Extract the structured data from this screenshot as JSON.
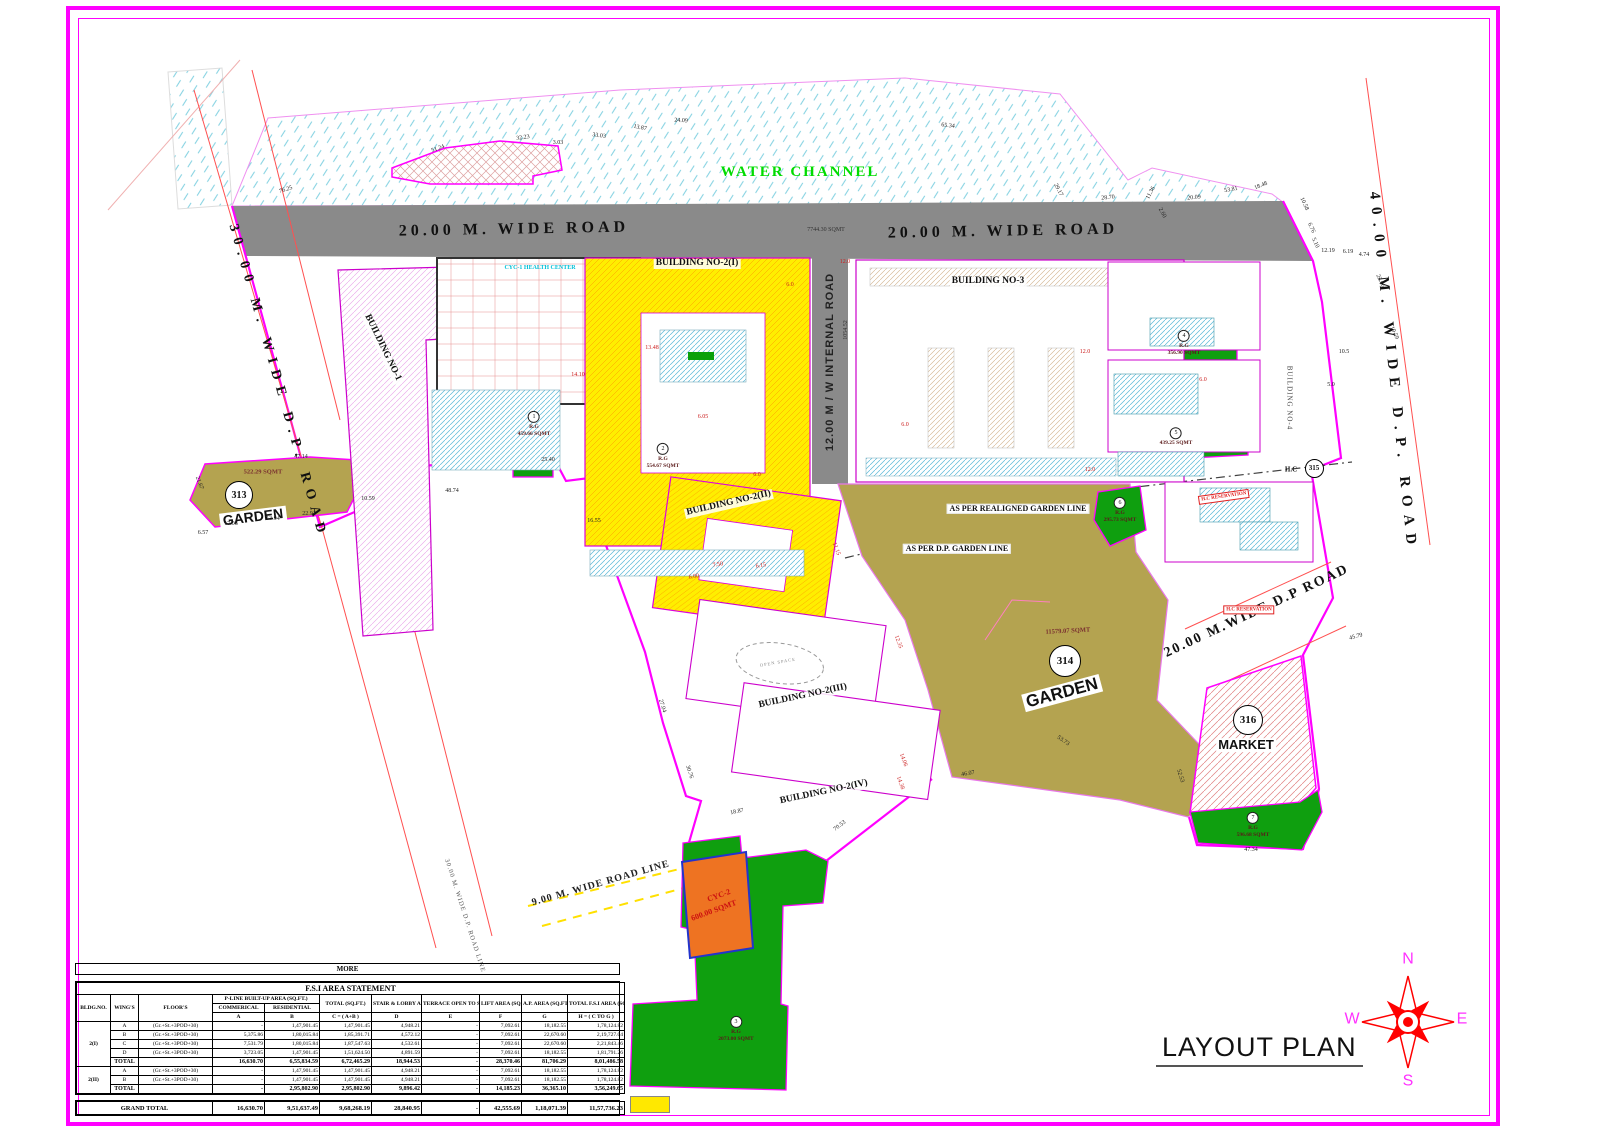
{
  "title": {
    "layout_plan": "LAYOUT PLAN"
  },
  "compass": {
    "letters": [
      {
        "name": "compass-n",
        "t": "N",
        "x": 1408,
        "y": 960
      },
      {
        "name": "compass-e",
        "t": "E",
        "x": 1462,
        "y": 1020
      },
      {
        "name": "compass-s",
        "t": "S",
        "x": 1408,
        "y": 1082
      },
      {
        "name": "compass-w",
        "t": "W",
        "x": 1352,
        "y": 1020
      }
    ]
  },
  "plan": {
    "labels": [
      {
        "name": "water-channel-label",
        "t": "WATER CHANNEL",
        "x": 800,
        "y": 173,
        "r": 0,
        "c": "water"
      },
      {
        "name": "road-20m-label-left",
        "t": "20.00 M. WIDE ROAD",
        "x": 514,
        "y": 230,
        "r": -1,
        "c": "road20"
      },
      {
        "name": "road-20m-label-right",
        "t": "20.00 M. WIDE ROAD",
        "x": 1003,
        "y": 232,
        "r": -1,
        "c": "road20"
      },
      {
        "name": "road-20m-area",
        "t": "7744.30 SQMT",
        "x": 826,
        "y": 230,
        "r": 0,
        "c": "tiny"
      },
      {
        "name": "road-30m-label",
        "t": "30.00 M. WIDE D.P. ROAD",
        "x": 277,
        "y": 382,
        "r": 74,
        "c": "road30"
      },
      {
        "name": "road-40m-label",
        "t": "40.00 M. WIDE D.P. ROAD",
        "x": 1392,
        "y": 372,
        "r": 84,
        "c": "road40"
      },
      {
        "name": "internal-road-label",
        "t": "12.00 M / W INTERNAL ROAD",
        "x": 831,
        "y": 362,
        "r": -90,
        "c": "internal"
      },
      {
        "name": "internal-road-area",
        "t": "1054.52",
        "x": 846,
        "y": 330,
        "r": -90,
        "c": "tiny"
      },
      {
        "name": "road-20m-dp-label",
        "t": "20.00 M.WIDE D.P ROAD",
        "x": 1257,
        "y": 612,
        "r": -25,
        "c": "dproad"
      },
      {
        "name": "road-9m-line-label",
        "t": "9.00 M. WIDE ROAD LINE",
        "x": 601,
        "y": 884,
        "r": -16,
        "c": "road9"
      },
      {
        "name": "road-30m-line-label",
        "t": "30.00 M. WIDE D.P. ROAD LINE",
        "x": 464,
        "y": 916,
        "r": 72,
        "c": "road30line"
      },
      {
        "name": "building-2i-label",
        "t": "BUILDING NO-2(I)",
        "x": 697,
        "y": 264,
        "r": 0,
        "c": "bld"
      },
      {
        "name": "building-3-label",
        "t": "BUILDING NO-3",
        "x": 988,
        "y": 282,
        "r": 0,
        "c": "bld"
      },
      {
        "name": "building-2ii-label",
        "t": "BUILDING NO-2(II)",
        "x": 729,
        "y": 504,
        "r": -13,
        "c": "bld"
      },
      {
        "name": "building-2iii-label",
        "t": "BUILDING NO-2(III)",
        "x": 803,
        "y": 697,
        "r": -12,
        "c": "bld"
      },
      {
        "name": "building-2iv-label",
        "t": "BUILDING NO-2(IV)",
        "x": 824,
        "y": 793,
        "r": -12,
        "c": "bld"
      },
      {
        "name": "building-1-label",
        "t": "BUILDING NO-1",
        "x": 382,
        "y": 348,
        "r": 64,
        "c": "bld"
      },
      {
        "name": "building-4-label",
        "t": "BUILDING NO-4",
        "x": 1289,
        "y": 398,
        "r": 90,
        "c": "bldsm"
      },
      {
        "name": "cyc1-health-center-label",
        "t": "CYC-1 HEALTH CENTER",
        "x": 540,
        "y": 268,
        "r": 0,
        "c": "cyan"
      },
      {
        "name": "garden-313-area",
        "t": "522.29 SQMT",
        "x": 263,
        "y": 473,
        "r": 0,
        "c": "sq"
      },
      {
        "name": "garden-313-name",
        "t": "GARDEN",
        "x": 253,
        "y": 517,
        "r": -7,
        "c": "gname313"
      },
      {
        "name": "garden-314-area",
        "t": "11579.07 SQMT",
        "x": 1068,
        "y": 632,
        "r": -3,
        "c": "sq"
      },
      {
        "name": "garden-314-name",
        "t": "GARDEN",
        "x": 1062,
        "y": 693,
        "r": -15,
        "c": "gname314"
      },
      {
        "name": "market-316-name",
        "t": "MARKET",
        "x": 1246,
        "y": 745,
        "r": 0,
        "c": "mname"
      },
      {
        "name": "hc-label",
        "t": "H.C",
        "x": 1291,
        "y": 470,
        "r": 0,
        "c": "hc"
      },
      {
        "name": "note-realigned-garden",
        "t": "AS PER REALIGNED GARDEN LINE",
        "x": 1018,
        "y": 509,
        "r": 0,
        "c": "note"
      },
      {
        "name": "note-dp-garden",
        "t": "AS PER D.P. GARDEN LINE",
        "x": 957,
        "y": 549,
        "r": 0,
        "c": "note"
      },
      {
        "name": "hc-reservation-1",
        "t": "H.C RESERVATION",
        "x": 1224,
        "y": 497,
        "r": -8,
        "c": "hcres"
      },
      {
        "name": "hc-reservation-2",
        "t": "H.C RESERVATION",
        "x": 1249,
        "y": 610,
        "r": 0,
        "c": "hcres"
      },
      {
        "name": "cyc2-label",
        "t": "CYC-2",
        "x": 719,
        "y": 896,
        "r": -20,
        "c": "cyc2"
      },
      {
        "name": "cyc2-area",
        "t": "600.00 SQMT",
        "x": 714,
        "y": 911,
        "r": -20,
        "c": "cyc2"
      },
      {
        "name": "open-space-label",
        "t": "OPEN SPACE",
        "x": 778,
        "y": 663,
        "r": -10,
        "c": "open"
      }
    ],
    "circles": [
      {
        "name": "garden-313-number",
        "t": "313",
        "x": 238,
        "y": 494,
        "d": 26,
        "f": 10
      },
      {
        "name": "garden-314-number",
        "t": "314",
        "x": 1064,
        "y": 660,
        "d": 30,
        "f": 11
      },
      {
        "name": "market-316-number",
        "t": "316",
        "x": 1247,
        "y": 719,
        "d": 28,
        "f": 11
      },
      {
        "name": "hc-315-number",
        "t": "315",
        "x": 1313,
        "y": 467,
        "d": 17,
        "f": 7
      }
    ],
    "rg": [
      {
        "num": "1",
        "l1": "R.G",
        "l2": "459.66 SQMT",
        "x": 534,
        "y": 421
      },
      {
        "num": "2",
        "l1": "R.G",
        "l2": "554.67 SQMT",
        "x": 663,
        "y": 453
      },
      {
        "num": "3",
        "l1": "R.G",
        "l2": "2073.00 SQMT",
        "x": 736,
        "y": 1026
      },
      {
        "num": "4",
        "l1": "R.G",
        "l2": "356.90 SQMT",
        "x": 1184,
        "y": 340
      },
      {
        "num": "5",
        "l1": "",
        "l2": "439.25 SQMT",
        "x": 1176,
        "y": 434
      },
      {
        "num": "6",
        "l1": "R.G",
        "l2": "295.73 SQMT",
        "x": 1120,
        "y": 507
      },
      {
        "num": "7",
        "l1": "R.G",
        "l2": "596.68 SQMT",
        "x": 1253,
        "y": 822
      }
    ],
    "dims": [
      {
        "t": "76.25",
        "x": 286,
        "y": 190,
        "r": -18
      },
      {
        "t": "51.24",
        "x": 438,
        "y": 149,
        "r": -20
      },
      {
        "t": "32.23",
        "x": 523,
        "y": 138,
        "r": -8
      },
      {
        "t": "3.03",
        "x": 558,
        "y": 143,
        "r": 0
      },
      {
        "t": "33.03",
        "x": 599,
        "y": 136,
        "r": 8
      },
      {
        "t": "13.87",
        "x": 640,
        "y": 128,
        "r": 12
      },
      {
        "t": "24.09",
        "x": 681,
        "y": 121,
        "r": 3
      },
      {
        "t": "65.34",
        "x": 948,
        "y": 126,
        "r": 6
      },
      {
        "t": "29.17",
        "x": 1058,
        "y": 190,
        "r": 62
      },
      {
        "t": "28.70",
        "x": 1108,
        "y": 198,
        "r": -5
      },
      {
        "t": "11.36",
        "x": 1151,
        "y": 193,
        "r": -62
      },
      {
        "t": "2.60",
        "x": 1162,
        "y": 213,
        "r": 62
      },
      {
        "t": "20.09",
        "x": 1194,
        "y": 198,
        "r": -5
      },
      {
        "t": "53.81",
        "x": 1231,
        "y": 190,
        "r": -10
      },
      {
        "t": "18.48",
        "x": 1261,
        "y": 186,
        "r": -22
      },
      {
        "t": "10.58",
        "x": 1304,
        "y": 204,
        "r": 65
      },
      {
        "t": "6.76",
        "x": 1311,
        "y": 228,
        "r": 65
      },
      {
        "t": "5.10",
        "x": 1315,
        "y": 243,
        "r": 65
      },
      {
        "t": "12.19",
        "x": 1328,
        "y": 251,
        "r": 0
      },
      {
        "t": "6.19",
        "x": 1348,
        "y": 252,
        "r": 0
      },
      {
        "t": "4.74",
        "x": 1364,
        "y": 255,
        "r": 0
      },
      {
        "t": "22.66",
        "x": 1380,
        "y": 281,
        "r": 65
      },
      {
        "t": "19.59",
        "x": 1394,
        "y": 333,
        "r": 65
      },
      {
        "t": "47.14",
        "x": 301,
        "y": 457,
        "r": 0
      },
      {
        "t": "21.67",
        "x": 199,
        "y": 483,
        "r": 70
      },
      {
        "t": "6.57",
        "x": 203,
        "y": 533,
        "r": 0
      },
      {
        "t": "17.08",
        "x": 231,
        "y": 524,
        "r": 0
      },
      {
        "t": "13.94",
        "x": 273,
        "y": 519,
        "r": 0
      },
      {
        "t": "22.91",
        "x": 309,
        "y": 514,
        "r": 0
      },
      {
        "t": "10.59",
        "x": 368,
        "y": 499,
        "r": 0
      },
      {
        "t": "48.74",
        "x": 452,
        "y": 491,
        "r": 0
      },
      {
        "t": "25.40",
        "x": 548,
        "y": 460,
        "r": 0
      },
      {
        "t": "16.55",
        "x": 594,
        "y": 521,
        "r": 0
      },
      {
        "t": "27.04",
        "x": 662,
        "y": 706,
        "r": 72
      },
      {
        "t": "30.76",
        "x": 689,
        "y": 772,
        "r": 72
      },
      {
        "t": "18.87",
        "x": 737,
        "y": 812,
        "r": -12
      },
      {
        "t": "70.53",
        "x": 840,
        "y": 826,
        "r": -38
      },
      {
        "t": "46.07",
        "x": 968,
        "y": 774,
        "r": -10
      },
      {
        "t": "53.73",
        "x": 1063,
        "y": 741,
        "r": 35
      },
      {
        "t": "52.53",
        "x": 1180,
        "y": 776,
        "r": 72
      },
      {
        "t": "47.34",
        "x": 1251,
        "y": 850,
        "r": 0
      },
      {
        "t": "45.79",
        "x": 1356,
        "y": 637,
        "r": -15
      },
      {
        "t": "10.5",
        "x": 1344,
        "y": 352,
        "r": 0
      },
      {
        "t": "5.0",
        "x": 1331,
        "y": 385,
        "r": 0
      },
      {
        "t": "12.0",
        "x": 845,
        "y": 262,
        "r": 0,
        "k": "r"
      },
      {
        "t": "6.0",
        "x": 790,
        "y": 285,
        "r": 0,
        "k": "r"
      },
      {
        "t": "13.48",
        "x": 652,
        "y": 348,
        "r": 0,
        "k": "r"
      },
      {
        "t": "14.10",
        "x": 578,
        "y": 375,
        "r": 0,
        "k": "r"
      },
      {
        "t": "6.05",
        "x": 703,
        "y": 417,
        "r": 0,
        "k": "r"
      },
      {
        "t": "11.15",
        "x": 836,
        "y": 549,
        "r": 70,
        "k": "r"
      },
      {
        "t": "7.50",
        "x": 718,
        "y": 565,
        "r": -10,
        "k": "r"
      },
      {
        "t": "6.00",
        "x": 694,
        "y": 577,
        "r": -10,
        "k": "r"
      },
      {
        "t": "6.15",
        "x": 761,
        "y": 566,
        "r": -10,
        "k": "r"
      },
      {
        "t": "14.06",
        "x": 903,
        "y": 760,
        "r": 70,
        "k": "r"
      },
      {
        "t": "14.38",
        "x": 900,
        "y": 783,
        "r": 70,
        "k": "r"
      },
      {
        "t": "12.0",
        "x": 1085,
        "y": 352,
        "r": 0,
        "k": "r"
      },
      {
        "t": "6.0",
        "x": 757,
        "y": 475,
        "r": 0,
        "k": "r"
      },
      {
        "t": "6.0",
        "x": 905,
        "y": 425,
        "r": 0,
        "k": "r"
      },
      {
        "t": "12.0",
        "x": 1090,
        "y": 470,
        "r": 0,
        "k": "r"
      },
      {
        "t": "6.0",
        "x": 1203,
        "y": 380,
        "r": 0,
        "k": "r"
      },
      {
        "t": "12.35",
        "x": 898,
        "y": 642,
        "r": 70,
        "k": "r"
      }
    ]
  },
  "table": {
    "more": "MORE",
    "title": "F.S.I AREA STATEMENT",
    "h_bldg": "BLDG.NO.",
    "h_wing": "WING'S",
    "h_floor": "FLOOR'S",
    "h_pline": "P-LINE BUILT-UP AREA (SQ.FT.)",
    "h_comm": "COMMERICAL",
    "h_resi": "RESIDENTIAL",
    "h_total": "TOTAL (SQ.FT.)",
    "h_stair": "STAIR & LOBBY AREA (SQ.FT.)",
    "h_terrace": "TERRACE OPEN TO SKY AREA (SQ.FT.)",
    "h_lift": "LIFT AREA (SQ.FT.)",
    "h_ap": "A.P. AREA (SQ.FT.)",
    "h_fsi": "TOTAL F.S.I AREA (SQ.FT.)",
    "letters": [
      "A",
      "B",
      "C = ( A+B )",
      "D",
      "E",
      "F",
      "G",
      "H = ( C TO G )"
    ],
    "rows": [
      {
        "bldg": "2(I)",
        "span": 5,
        "wing": "A",
        "floor": "(Gr.+St.+3POD+30)",
        "a": "-",
        "b": "1,47,901.45",
        "c": "1,47,901.45",
        "d": "4,948.21",
        "e": "-",
        "f": "7,092.61",
        "g": "18,182.55",
        "h": "1,78,124.82"
      },
      {
        "wing": "B",
        "floor": "(Gr.+St.+3POD+30)",
        "a": "5,375.86",
        "b": "1,80,015.84",
        "c": "1,85,391.71",
        "d": "4,572.12",
        "e": "-",
        "f": "7,092.61",
        "g": "22,670.60",
        "h": "2,19,727.04"
      },
      {
        "wing": "C",
        "floor": "(Gr.+St.+3POD+30)",
        "a": "7,531.79",
        "b": "1,80,015.84",
        "c": "1,87,547.63",
        "d": "4,532.61",
        "e": "-",
        "f": "7,092.61",
        "g": "22,670.60",
        "h": "2,21,843.46"
      },
      {
        "wing": "D",
        "floor": "(Gr.+St.+3POD+30)",
        "a": "3,723.05",
        "b": "1,47,901.45",
        "c": "1,51,624.50",
        "d": "4,891.59",
        "e": "-",
        "f": "7,092.61",
        "g": "18,182.55",
        "h": "1,81,791.26"
      },
      {
        "wing": "TOTAL",
        "total": true,
        "floor": "",
        "a": "16,630.70",
        "b": "6,55,834.59",
        "c": "6,72,465.29",
        "d": "18,944.53",
        "e": "-",
        "f": "28,370.46",
        "g": "81,706.29",
        "h": "8,01,486.58"
      },
      {
        "bldg": "2(II)",
        "span": 3,
        "wing": "A",
        "floor": "(Gr.+St.+3POD+30)",
        "a": "-",
        "b": "1,47,901.45",
        "c": "1,47,901.45",
        "d": "4,948.21",
        "e": "-",
        "f": "7,092.61",
        "g": "18,182.55",
        "h": "1,78,124.82"
      },
      {
        "wing": "B",
        "floor": "(Gr.+St.+3POD+30)",
        "a": "-",
        "b": "1,47,901.45",
        "c": "1,47,901.45",
        "d": "4,948.21",
        "e": "-",
        "f": "7,092.61",
        "g": "18,182.55",
        "h": "1,78,124.82"
      },
      {
        "wing": "TOTAL",
        "total": true,
        "floor": "",
        "a": "-",
        "b": "2,95,802.90",
        "c": "2,95,802.90",
        "d": "9,896.42",
        "e": "-",
        "f": "14,185.23",
        "g": "36,365.10",
        "h": "3,56,249.65"
      }
    ],
    "grand": {
      "label": "GRAND TOTAL",
      "a": "16,630.70",
      "b": "9,51,637.49",
      "c": "9,68,268.19",
      "d": "28,840.95",
      "e": "-",
      "f": "42,555.69",
      "g": "1,18,071.39",
      "h": "11,57,736.23"
    }
  }
}
